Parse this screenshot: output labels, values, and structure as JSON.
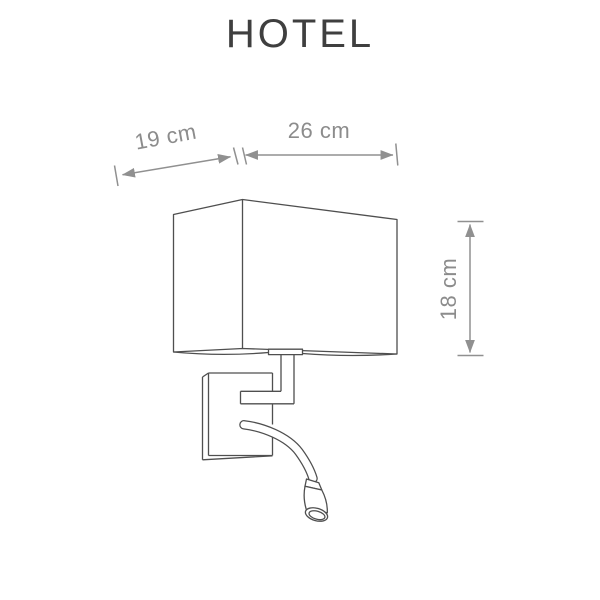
{
  "title": "HOTEL",
  "diagram": {
    "type": "product-dimension-drawing",
    "dimensions": {
      "depth": {
        "label": "19 cm"
      },
      "width": {
        "label": "26 cm"
      },
      "height": {
        "label": "18 cm"
      }
    }
  },
  "colors": {
    "background": "#ffffff",
    "drawing_line": "#4f4f4f",
    "dimension_line": "#909090",
    "dimension_text": "#8c8c8c",
    "title_text": "#3f3f3f"
  }
}
